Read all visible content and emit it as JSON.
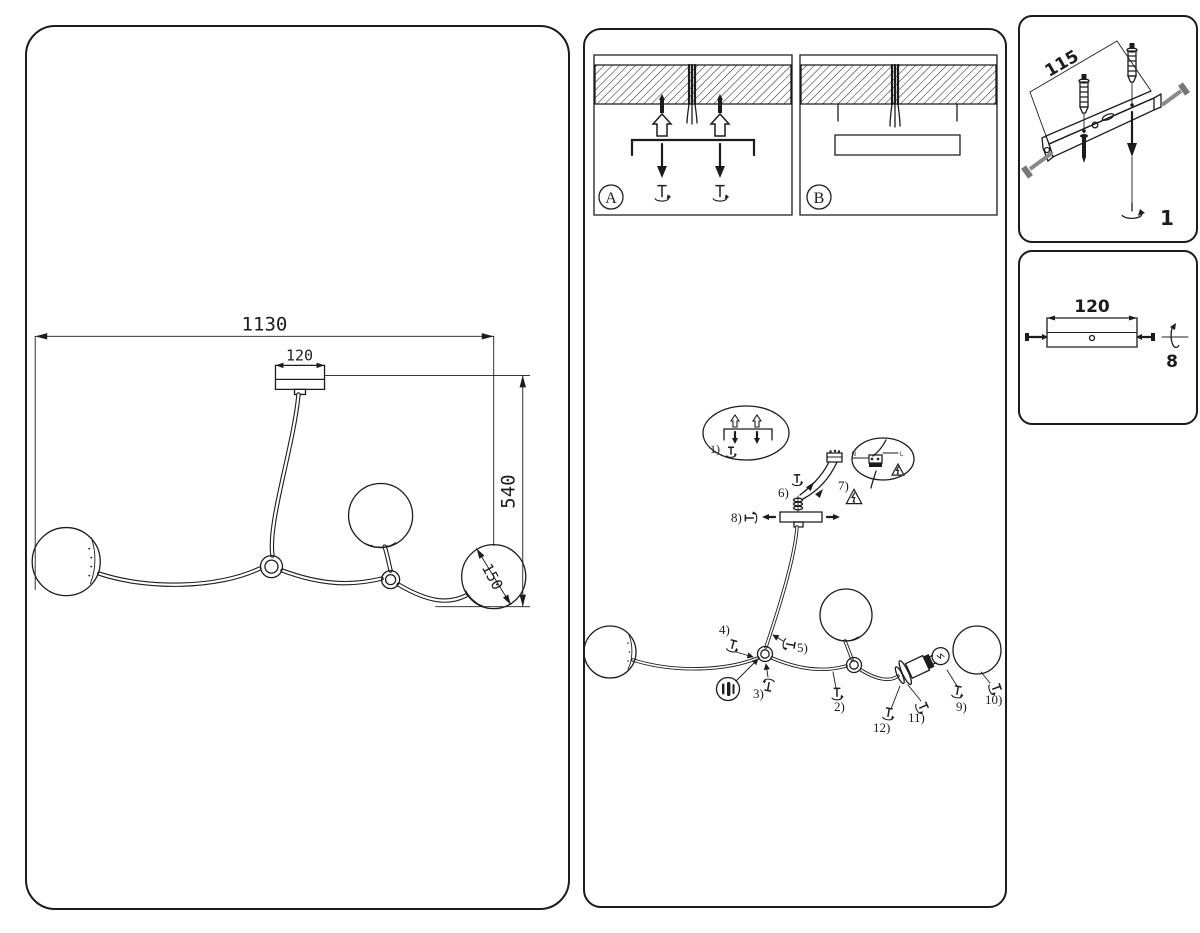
{
  "drawing_panel": {
    "dim_total_width": "1130",
    "dim_canopy_width": "120",
    "dim_height": "540",
    "dim_shade_diameter": "150"
  },
  "instructions_panel": {
    "variant_a_label": "A",
    "variant_b_label": "B",
    "wire_neutral": "N",
    "wire_live": "L",
    "steps": {
      "s1": "1)",
      "s2": "2)",
      "s3": "3)",
      "s4": "4)",
      "s5": "5)",
      "s6": "6)",
      "s7": "7)",
      "s8": "8)",
      "s9": "9)",
      "s10": "10)",
      "s11": "11)",
      "s12": "12)"
    }
  },
  "bracket_panel": {
    "dim_spacing": "115",
    "step_label": "1"
  },
  "canopy_panel": {
    "dim_width": "120",
    "step_label": "8"
  },
  "colors": {
    "line": "#1c1c1c",
    "screw_gray": "#8a8a8a"
  }
}
